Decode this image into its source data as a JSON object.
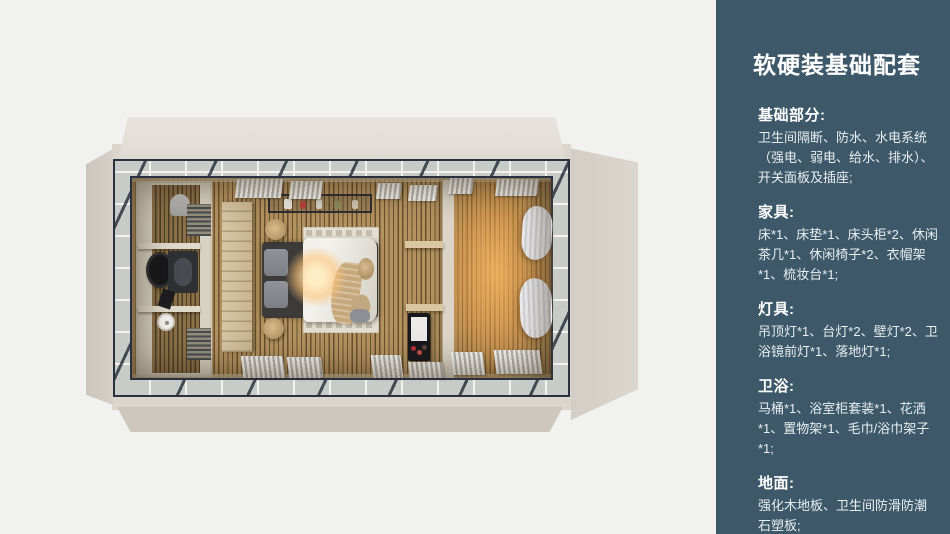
{
  "sidebar": {
    "title": "软硬装基础配套",
    "sections": [
      {
        "heading": "基础部分:",
        "body": "卫生间隔断、防水、水电系统（强电、弱电、给水、排水）、开关面板及插座;"
      },
      {
        "heading": "家具:",
        "body": "床*1、床垫*1、床头柜*2、休闲茶几*1、休闲椅子*2、衣帽架*1、梳妆台*1;"
      },
      {
        "heading": "灯具:",
        "body": "吊顶灯*1、台灯*2、壁灯*2、卫浴镜前灯*1、落地灯*1;"
      },
      {
        "heading": "卫浴:",
        "body": "马桶*1、浴室柜套装*1、花洒*1、置物架*1、毛巾/浴巾架子*1;"
      },
      {
        "heading": "地面:",
        "body": "强化木地板、卫生间防滑防潮石塑板;"
      }
    ]
  },
  "colors": {
    "sidebar_bg": "#3d5868",
    "page_bg": "#f1f1f0",
    "shell_beige": "#dbd5cd",
    "frame_dark": "#2a3140",
    "wood_floor_light": "#b3925f",
    "wood_floor_dark": "#68512f",
    "warm_glow": "#ffba60"
  }
}
